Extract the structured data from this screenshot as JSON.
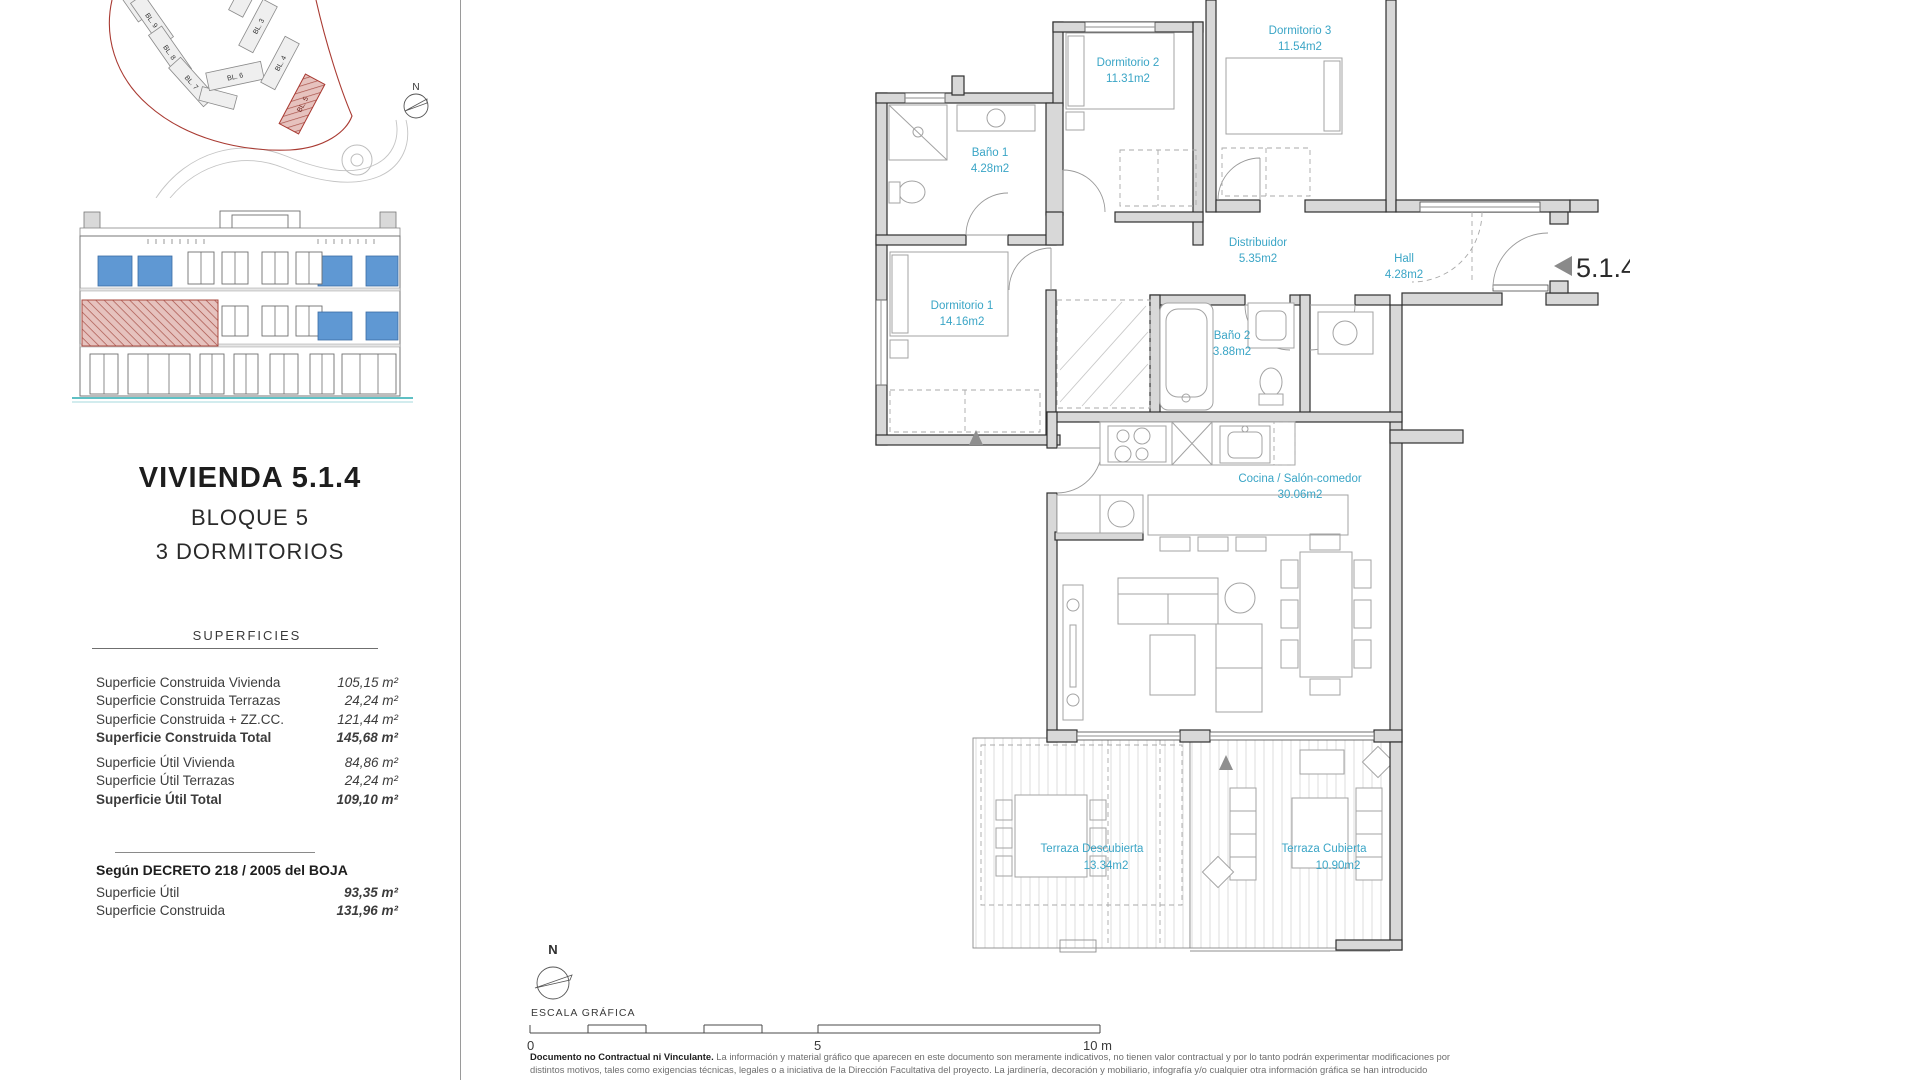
{
  "site_plan": {
    "north_label": "N",
    "blocks": [
      {
        "label": "BL. 9"
      },
      {
        "label": "BL. 8"
      },
      {
        "label": "BL. 7"
      },
      {
        "label": "BL. 6"
      },
      {
        "label": "BL. 3"
      },
      {
        "label": "BL. 4"
      },
      {
        "label": "BL. 5"
      }
    ],
    "highlight_color": "#a93a32"
  },
  "panel": {
    "title": "VIVIENDA 5.1.4",
    "block": "BLOQUE 5",
    "bedrooms": "3 DORMITORIOS",
    "superficies_header": "SUPERFICIES",
    "construida_rows": [
      {
        "label": "Superficie Construida Vivienda",
        "value": "105,15 m²"
      },
      {
        "label": "Superficie Construida Terrazas",
        "value": "24,24 m²"
      },
      {
        "label": "Superficie Construida + ZZ.CC.",
        "value": "121,44 m²"
      },
      {
        "label": "Superficie Construida Total",
        "value": "145,68 m²"
      }
    ],
    "util_rows": [
      {
        "label": "Superficie Útil Vivienda",
        "value": "84,86 m²"
      },
      {
        "label": "Superficie Útil Terrazas",
        "value": "24,24 m²"
      },
      {
        "label": "Superficie Útil Total",
        "value": "109,10 m²"
      }
    ],
    "decreto": {
      "header": "Según DECRETO 218 / 2005 del BOJA",
      "rows": [
        {
          "label": "Superficie Útil",
          "value": "93,35 m²"
        },
        {
          "label": "Superficie Construida",
          "value": "131,96 m²"
        }
      ]
    }
  },
  "floor_plan": {
    "unit_label": "5.1.4",
    "label_color": "#3aa5c6",
    "rooms": [
      {
        "name": "Dormitorio 2",
        "area": "11.31m2"
      },
      {
        "name": "Dormitorio 3",
        "area": "11.54m2"
      },
      {
        "name": "Baño 1",
        "area": "4.28m2"
      },
      {
        "name": "Distribuidor",
        "area": "5.35m2"
      },
      {
        "name": "Hall",
        "area": "4.28m2"
      },
      {
        "name": "Dormitorio 1",
        "area": "14.16m2"
      },
      {
        "name": "Baño 2",
        "area": "3.88m2"
      },
      {
        "name": "Cocina / Salón-comedor",
        "area": "30.06m2"
      },
      {
        "name": "Terraza Descubierta",
        "area": "13.34m2"
      },
      {
        "name": "Terraza Cubierta",
        "area": "10.90m2"
      }
    ]
  },
  "scale_area": {
    "north_label": "N",
    "escala_label": "ESCALA GRÁFICA",
    "tick_0": "0",
    "tick_5": "5",
    "tick_10": "10 m"
  },
  "disclaimer": {
    "lead": "Documento no Contractual ni Vinculante.",
    "line1": " La información y material gráfico que aparecen en este documento son meramente indicativos, no tienen valor contractual y por lo tanto podrán experimentar modificaciones por",
    "line2": "distintos motivos, tales como exigencias técnicas, legales o a iniciativa de la Dirección Facultativa del proyecto. La jardinería, decoración y mobiliario, infografía y/o cualquier otra información gráfica se han introducido"
  }
}
